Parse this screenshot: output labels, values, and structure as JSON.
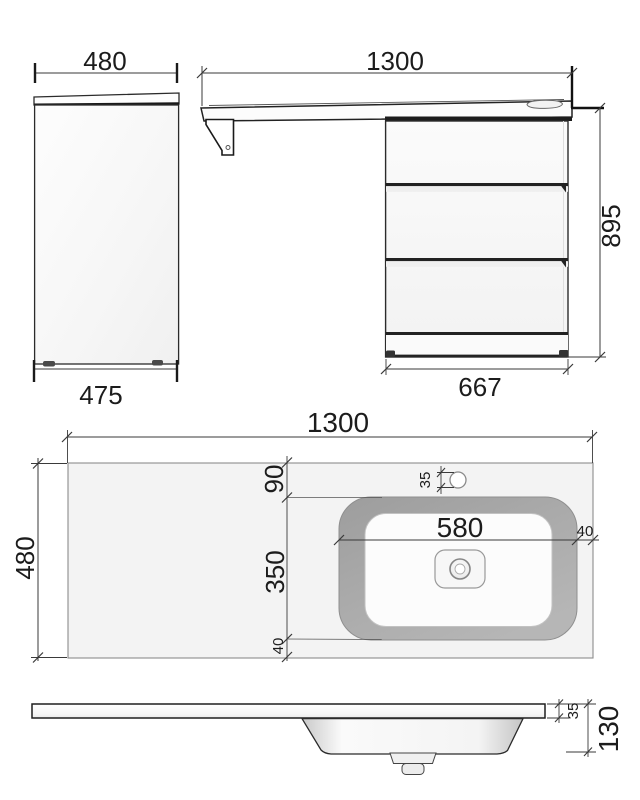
{
  "drawing": {
    "title": "vanity-unit-technical-drawing",
    "units": "mm",
    "side_view": {
      "depth_top": "480",
      "depth_bottom": "475"
    },
    "front_view": {
      "total_width": "1300",
      "total_height": "895",
      "cabinet_width": "667"
    },
    "top_view": {
      "total_width": "1300",
      "total_depth": "480",
      "back_offset": "90",
      "basin_depth": "350",
      "front_offset": "40",
      "basin_width": "580",
      "right_offset": "40",
      "faucet_hole_diameter": "35"
    },
    "profile_view": {
      "countertop_thickness": "35",
      "total_height": "130"
    },
    "colors": {
      "line": "#2b2b2b",
      "dim_line": "#3a3a3a",
      "panel_fill": "#f7f7f7",
      "counter_fill": "#f3f3f3",
      "basin_band": "#a6a6a6"
    }
  }
}
